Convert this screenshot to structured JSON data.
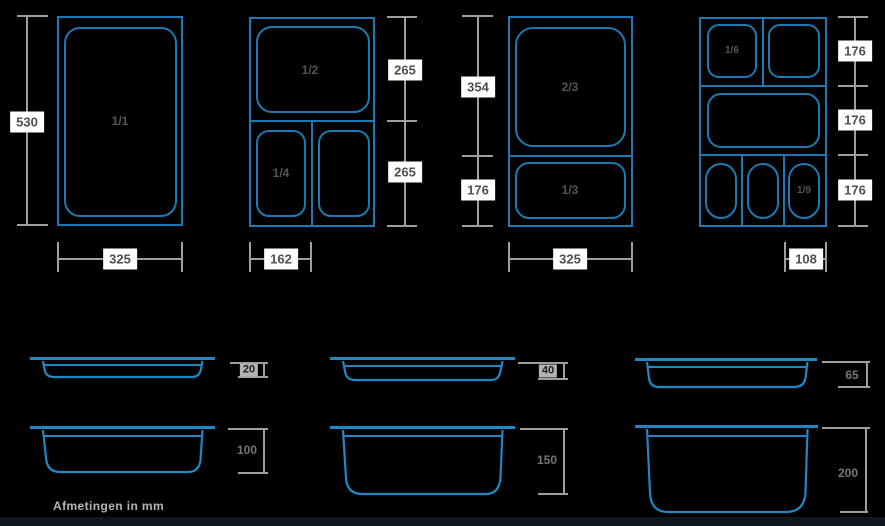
{
  "colors": {
    "background": "#000000",
    "plan_line": "#1d79b0",
    "profile_line": "#2187c2",
    "dim_line": "#9e9e9e",
    "dim_box_bg": "#ffffff",
    "dim_box_text": "#4f4f4f",
    "fraction_text": "#545454",
    "depth_text": "#767676",
    "depth_box_bg": "#b3b3b3",
    "depth_box_text": "#1d1d1d",
    "footer_text": "#b5b5b5",
    "bottom_strip": "#10161e"
  },
  "plans": [
    {
      "fractions": [
        "1/1"
      ],
      "height_dims": [
        "530"
      ],
      "width_dim": "325"
    },
    {
      "fractions": [
        "1/2",
        "1/4"
      ],
      "height_dims": [
        "265",
        "265"
      ],
      "width_dim": "162"
    },
    {
      "fractions": [
        "2/3",
        "1/3"
      ],
      "height_dims": [
        "354",
        "176"
      ],
      "width_dim": "325"
    },
    {
      "fractions": [
        "1/6",
        "1/9"
      ],
      "height_dims": [
        "176",
        "176",
        "176"
      ],
      "width_dim": "108"
    }
  ],
  "profiles": [
    {
      "depth": "20"
    },
    {
      "depth": "40"
    },
    {
      "depth": "65"
    },
    {
      "depth": "100"
    },
    {
      "depth": "150"
    },
    {
      "depth": "200"
    }
  ],
  "footer": {
    "note": "Afmetingen in mm"
  }
}
